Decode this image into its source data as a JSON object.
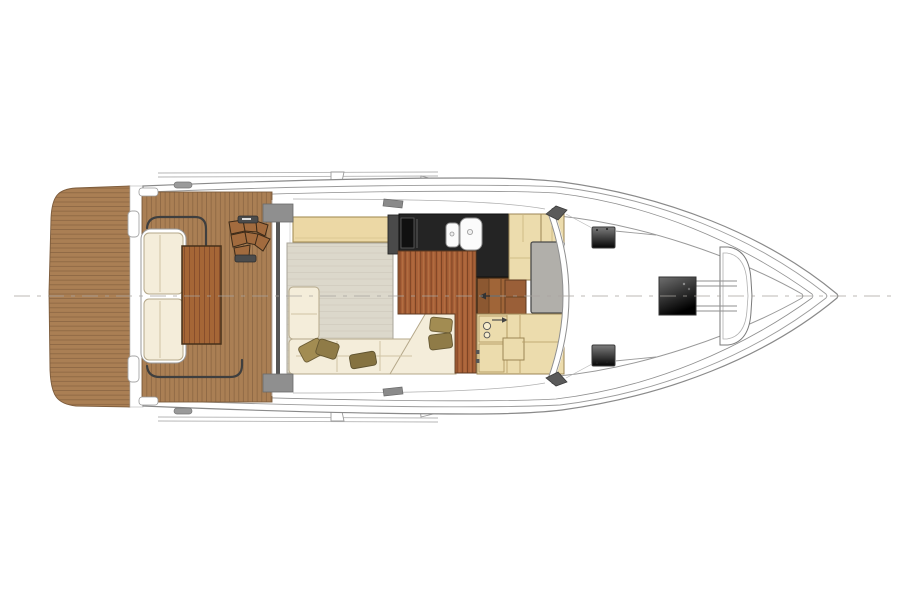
{
  "meta": {
    "type": "yacht-main-deck-floor-plan",
    "view": "top-down, bow pointing right",
    "background": "#ffffff"
  },
  "palette": {
    "teak": "#aa7f54",
    "teak_line": "#8d6743",
    "table_wood": "#a56636",
    "table_edge": "#46301a",
    "galley_floor": "#a86037",
    "galley_floor_line": "#7b4223",
    "counter_black": "#242424",
    "cream": "#f4edda",
    "cushion_edge": "#b5a88a",
    "pillow_light": "#a28c52",
    "pillow_dark": "#8f7b47",
    "carpet": "#dcd8cb",
    "sideboard_tan": "#ecd8a5",
    "cabinet_beige": "#ecdcad",
    "cabinet_edge": "#9c8655",
    "step_wood": "#a06538",
    "mat_grey": "#b1afaa",
    "pad_grey": "#8a8a8a",
    "hull_line": "#8a8a8a",
    "hatch_dark": "#0a0a0a",
    "white": "#ffffff",
    "centerline_grey": "#a8a49e"
  },
  "regions": {
    "swim_platform": {
      "label": "Teak swim platform"
    },
    "transom": {
      "label": "Transom lockers"
    },
    "cockpit": {
      "label": "Aft cockpit teak deck"
    },
    "cockpit_bench": {
      "label": "Cockpit bench seat"
    },
    "cockpit_table": {
      "label": "Cockpit teak table"
    },
    "flybridge_stairs": {
      "label": "Curved steps to flybridge"
    },
    "salon": {
      "label": "Salon with carpet"
    },
    "salon_sofa": {
      "label": "L-shaped sofa with pillows"
    },
    "sideboard": {
      "label": "Sideboard cabinet"
    },
    "galley": {
      "label": "Galley counter with twin sinks and cooktop"
    },
    "companionway": {
      "label": "Steps down to accommodation deck"
    },
    "helm": {
      "label": "Helm station area"
    },
    "windshield": {
      "label": "Curved windshield"
    },
    "foredeck": {
      "label": "Foredeck with hatches"
    },
    "windlass": {
      "label": "Anchor windlass hatch"
    },
    "bow_platform": {
      "label": "Bow anchor platform"
    },
    "centerline": {
      "label": "Hull centerline (dashed)"
    }
  }
}
